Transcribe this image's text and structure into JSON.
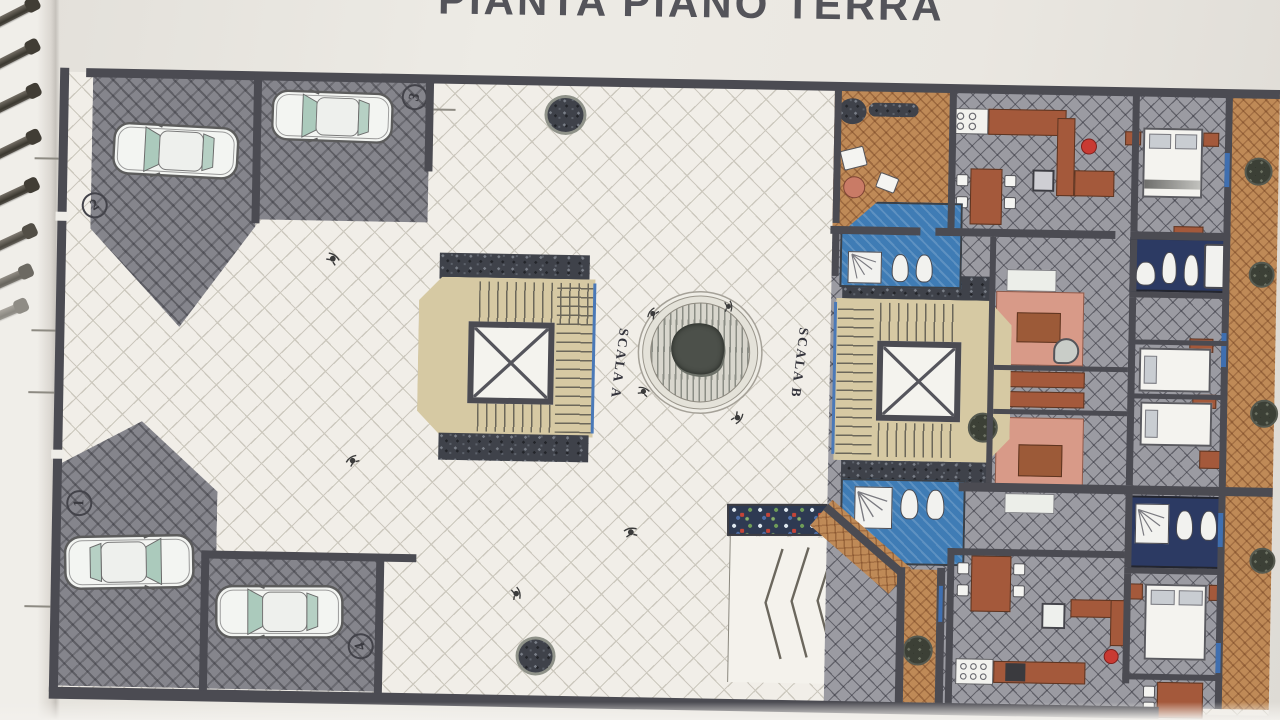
{
  "title": {
    "text": "PIANTA PIANO TERRA"
  },
  "plan": {
    "stair_labels": {
      "a": "SCALA A",
      "b": "SCALA B"
    },
    "parking_spaces": [
      {
        "number": "2"
      },
      {
        "number": "3"
      },
      {
        "number": "1"
      },
      {
        "number": "4"
      }
    ],
    "colors": {
      "paper": "#eae7e1",
      "title_ink": "#54545a",
      "wall": "#4b4b52",
      "parking_paving": "#85858c",
      "courtyard_tile": "#f1eee8",
      "stair_floor": "#d6c9a3",
      "terracotta_tile": "#bf8a57",
      "apartment_tile": "#9b9ba2",
      "bathroom_blue": "#3f7cb5",
      "bathroom_navy": "#2c3a63",
      "bed_pink": "#d89a88",
      "furniture_brown": "#a4593b",
      "accent_red": "#c93a33",
      "car_glass": "#abcabc"
    }
  }
}
